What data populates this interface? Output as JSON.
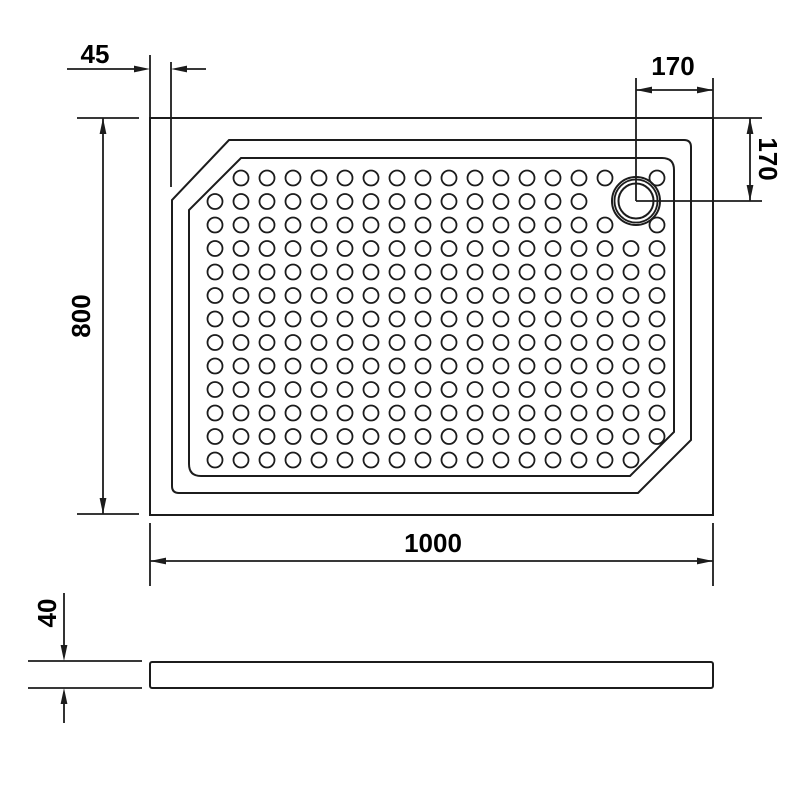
{
  "drawing": {
    "view_top": "top view of rectangular shower tray with chamfered corners, anti-slip dot grid and corner drain",
    "view_side": "side profile of tray",
    "colors": {
      "line": "#1c1c1c",
      "background": "#ffffff"
    },
    "dimensions": {
      "rim_offset": "45",
      "drain_from_right_edge": "170",
      "drain_from_top_edge": "170",
      "tray_depth": "800",
      "tray_width": "1000",
      "tray_height": "40"
    }
  }
}
